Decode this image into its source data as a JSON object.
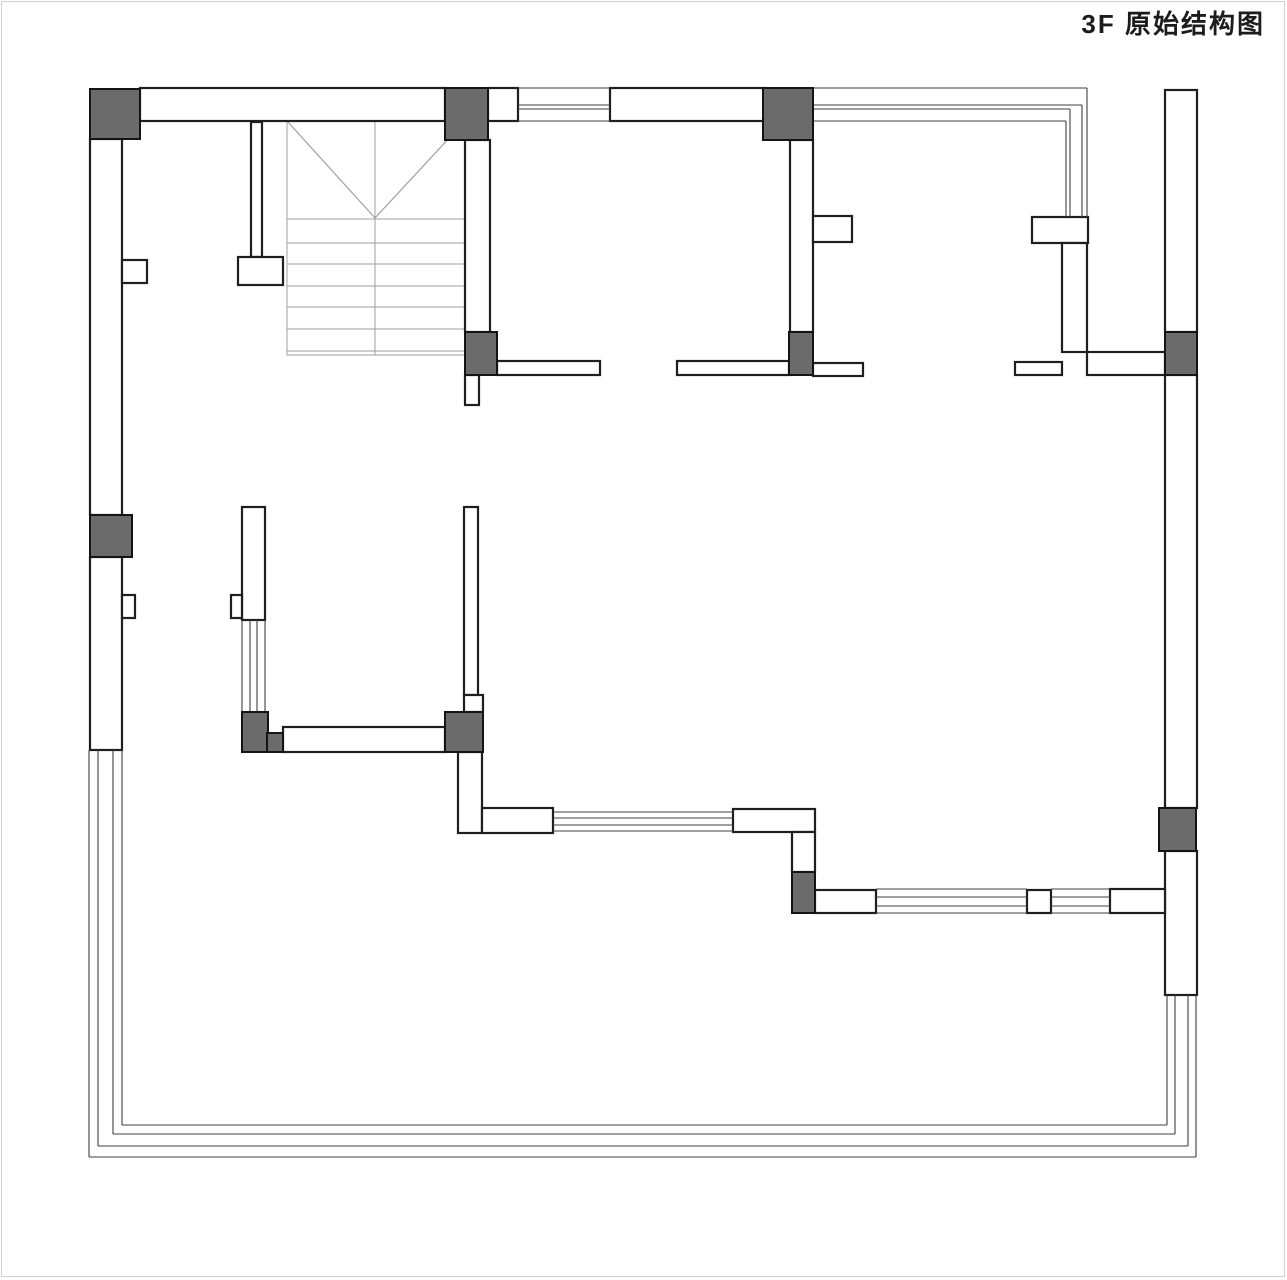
{
  "page": {
    "title": "3F  原始结构图",
    "background": "#ffffff",
    "frame_color": "#cfcfcf"
  },
  "drawing": {
    "canvas": {
      "width": 1287,
      "height": 1280
    },
    "colors": {
      "wall_fill": "#ffffff",
      "wall_stroke": "#1f1f1f",
      "column_fill": "#6b6b6b",
      "column_stroke": "#141414",
      "window_line": "#3f3f3f",
      "stair_line": "#9f9f9f"
    },
    "walls": [
      [
        140,
        88,
        305,
        33
      ],
      [
        488,
        88,
        30,
        33
      ],
      [
        610,
        88,
        155,
        33
      ],
      [
        90,
        139,
        32,
        376
      ],
      [
        90,
        557,
        32,
        193
      ],
      [
        122,
        260,
        25,
        23
      ],
      [
        122,
        595,
        13,
        23
      ],
      [
        251,
        122,
        11,
        135
      ],
      [
        238,
        257,
        45,
        28
      ],
      [
        465,
        140,
        25,
        192
      ],
      [
        465,
        375,
        14,
        30
      ],
      [
        497,
        361,
        103,
        14
      ],
      [
        677,
        361,
        112,
        14
      ],
      [
        813,
        363,
        50,
        13
      ],
      [
        790,
        140,
        23,
        192
      ],
      [
        813,
        216,
        39,
        26
      ],
      [
        1032,
        217,
        56,
        26
      ],
      [
        1062,
        243,
        25,
        109
      ],
      [
        1015,
        362,
        47,
        13
      ],
      [
        1087,
        352,
        78,
        23
      ],
      [
        1165,
        90,
        32,
        242
      ],
      [
        1165,
        375,
        32,
        433
      ],
      [
        1165,
        851,
        32,
        144
      ],
      [
        242,
        507,
        23,
        113
      ],
      [
        231,
        595,
        11,
        23
      ],
      [
        283,
        727,
        162,
        25
      ],
      [
        464,
        507,
        14,
        188
      ],
      [
        464,
        695,
        19,
        17
      ],
      [
        458,
        752,
        24,
        81
      ],
      [
        482,
        808,
        71,
        25
      ],
      [
        733,
        809,
        82,
        23
      ],
      [
        792,
        832,
        23,
        40
      ],
      [
        815,
        890,
        61,
        23
      ],
      [
        1027,
        890,
        24,
        23
      ],
      [
        1110,
        889,
        55,
        24
      ]
    ],
    "columns": [
      [
        90,
        89,
        50,
        50
      ],
      [
        445,
        88,
        43,
        52
      ],
      [
        763,
        88,
        50,
        52
      ],
      [
        465,
        332,
        32,
        43
      ],
      [
        789,
        332,
        24,
        43
      ],
      [
        1165,
        332,
        32,
        43
      ],
      [
        90,
        515,
        42,
        42
      ],
      [
        242,
        712,
        26,
        40
      ],
      [
        267,
        733,
        16,
        19
      ],
      [
        445,
        712,
        38,
        40
      ],
      [
        792,
        872,
        23,
        41
      ],
      [
        1159,
        808,
        37,
        43
      ]
    ],
    "window_lines": [
      [
        518,
        88,
        610,
        88
      ],
      [
        518,
        105,
        610,
        105
      ],
      [
        518,
        109,
        610,
        109
      ],
      [
        518,
        121,
        610,
        121
      ],
      [
        813,
        88,
        1087,
        88
      ],
      [
        813,
        105,
        1082,
        105
      ],
      [
        813,
        109,
        1070,
        109
      ],
      [
        813,
        121,
        1066,
        121
      ],
      [
        1087,
        88,
        1087,
        217
      ],
      [
        1082,
        105,
        1082,
        217
      ],
      [
        1070,
        109,
        1070,
        217
      ],
      [
        1066,
        121,
        1066,
        217
      ],
      [
        89,
        750,
        89,
        1157
      ],
      [
        98,
        750,
        98,
        1146
      ],
      [
        113,
        750,
        113,
        1134
      ],
      [
        122,
        750,
        122,
        1125
      ],
      [
        89,
        1157,
        1196,
        1157
      ],
      [
        98,
        1146,
        1188,
        1146
      ],
      [
        113,
        1134,
        1175,
        1134
      ],
      [
        122,
        1125,
        1167,
        1125
      ],
      [
        1196,
        995,
        1196,
        1157
      ],
      [
        1188,
        995,
        1188,
        1146
      ],
      [
        1175,
        995,
        1175,
        1134
      ],
      [
        1167,
        995,
        1167,
        1125
      ],
      [
        242,
        620,
        242,
        712
      ],
      [
        250,
        620,
        250,
        712
      ],
      [
        257,
        620,
        257,
        712
      ],
      [
        265,
        620,
        265,
        712
      ],
      [
        553,
        812,
        733,
        812
      ],
      [
        553,
        818,
        733,
        818
      ],
      [
        553,
        825,
        733,
        825
      ],
      [
        553,
        831,
        733,
        831
      ],
      [
        876,
        889,
        1027,
        889
      ],
      [
        876,
        897,
        1027,
        897
      ],
      [
        876,
        906,
        1027,
        906
      ],
      [
        876,
        913,
        1027,
        913
      ],
      [
        1051,
        889,
        1110,
        889
      ],
      [
        1051,
        897,
        1110,
        897
      ],
      [
        1051,
        906,
        1110,
        906
      ],
      [
        1051,
        913,
        1110,
        913
      ]
    ],
    "stairs": {
      "bounds": [
        287,
        121,
        178,
        234
      ],
      "diagonals": [
        [
          287,
          121,
          375,
          218
        ],
        [
          465,
          121,
          375,
          218
        ]
      ],
      "center_line": [
        375,
        121,
        375,
        355
      ],
      "step_lines_y": [
        219,
        243,
        264,
        286,
        307,
        329,
        351
      ],
      "x_range": [
        287,
        465
      ]
    }
  }
}
